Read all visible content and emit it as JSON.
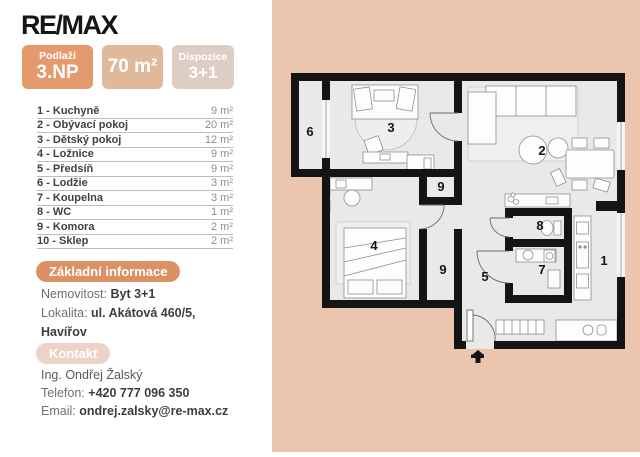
{
  "brand": {
    "logo_text": "RE/MAX"
  },
  "badges": {
    "floor": {
      "label": "Podlaží",
      "value": "3.NP"
    },
    "area": {
      "value": "70 m²"
    },
    "layout": {
      "label": "Dispozice",
      "value": "3+1"
    }
  },
  "room_list": [
    {
      "name": "1 - Kuchyně",
      "area": "9 m²"
    },
    {
      "name": "2 - Obývací pokoj",
      "area": "20 m²"
    },
    {
      "name": "3 - Dětský pokoj",
      "area": "12 m²"
    },
    {
      "name": "4 - Ložnice",
      "area": "9 m²"
    },
    {
      "name": "5 - Předsíň",
      "area": "9 m²"
    },
    {
      "name": "6 - Lodžie",
      "area": "3 m²"
    },
    {
      "name": "7 - Koupelna",
      "area": "3 m²"
    },
    {
      "name": "8 - WC",
      "area": "1 m²"
    },
    {
      "name": "9 - Komora",
      "area": "2 m²"
    },
    {
      "name": "10 - Sklep",
      "area": "2 m²"
    }
  ],
  "basic_info": {
    "title": "Základní informace",
    "property_label": "Nemovitost:",
    "property_value": "Byt 3+1",
    "location_label": "Lokalita:",
    "location_value": "ul. Akátová 460/5,",
    "location_value2": "Havířov"
  },
  "contact": {
    "title": "Kontakt",
    "agent": "Ing. Ondřej Žalský",
    "phone_label": "Telefon:",
    "phone": "+420 777 096 350",
    "email_label": "Email:",
    "email": "ondrej.zalsky@re-max.cz"
  },
  "floorplan": {
    "labels": [
      {
        "num": "6"
      },
      {
        "num": "3"
      },
      {
        "num": "2"
      },
      {
        "num": "9"
      },
      {
        "num": "4"
      },
      {
        "num": "9"
      },
      {
        "num": "5"
      },
      {
        "num": "8"
      },
      {
        "num": "7"
      },
      {
        "num": "1"
      }
    ]
  },
  "colors": {
    "panel_bg": "#ecc5ae",
    "badge_floor": "#e49a6c",
    "badge_area": "#e0b99b",
    "badge_layout": "#decdc4",
    "pill_basic": "#dc9165",
    "pill_contact": "#ecd3c5",
    "plan_floor": "#e9e9e7",
    "wall": "#141414"
  }
}
